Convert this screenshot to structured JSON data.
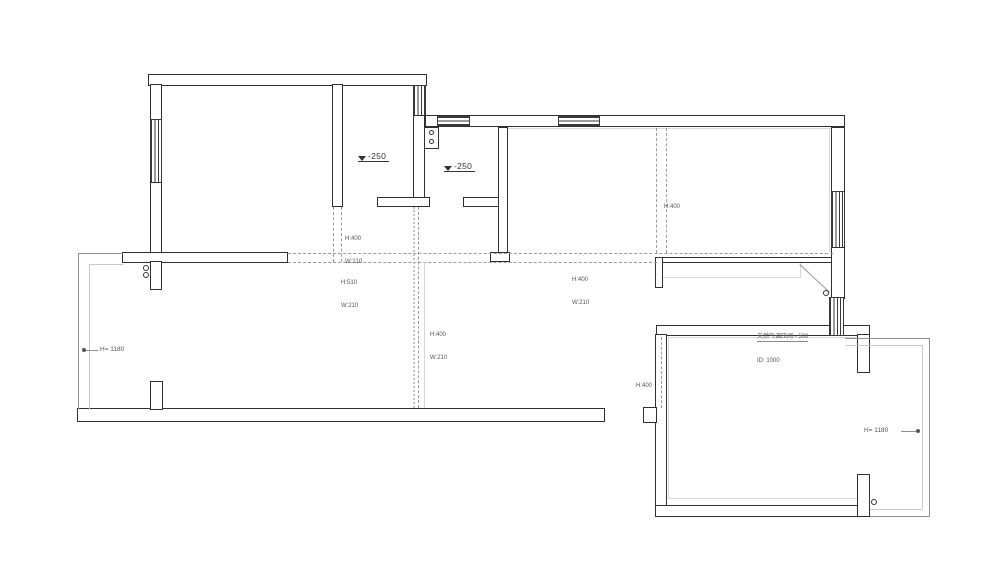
{
  "drawing": {
    "type": "floor-plan",
    "colors": {
      "wall_line": "#303030",
      "dashed_beam": "#9a9a9a",
      "light_face": "#d8d8d8",
      "text": "#555555"
    },
    "elevation_markers": [
      {
        "label": "-250"
      },
      {
        "label": "-250"
      }
    ],
    "beam_labels": [
      {
        "l1": "H:400",
        "l2": "W:210"
      },
      {
        "l1": "H:510",
        "l2": "W:210"
      },
      {
        "l1": "H:400",
        "l2": "W:210"
      },
      {
        "l1": "H:400",
        "l2": "W:210"
      },
      {
        "l1": "H:400",
        "l2": ""
      },
      {
        "l1": "H:400",
        "l2": ""
      }
    ],
    "height_labels": {
      "left": "H= 1180",
      "right": "H= 1180"
    },
    "gas_note": {
      "l1": "天然气调压阀 - 500",
      "l2": "ID: 1000"
    }
  }
}
